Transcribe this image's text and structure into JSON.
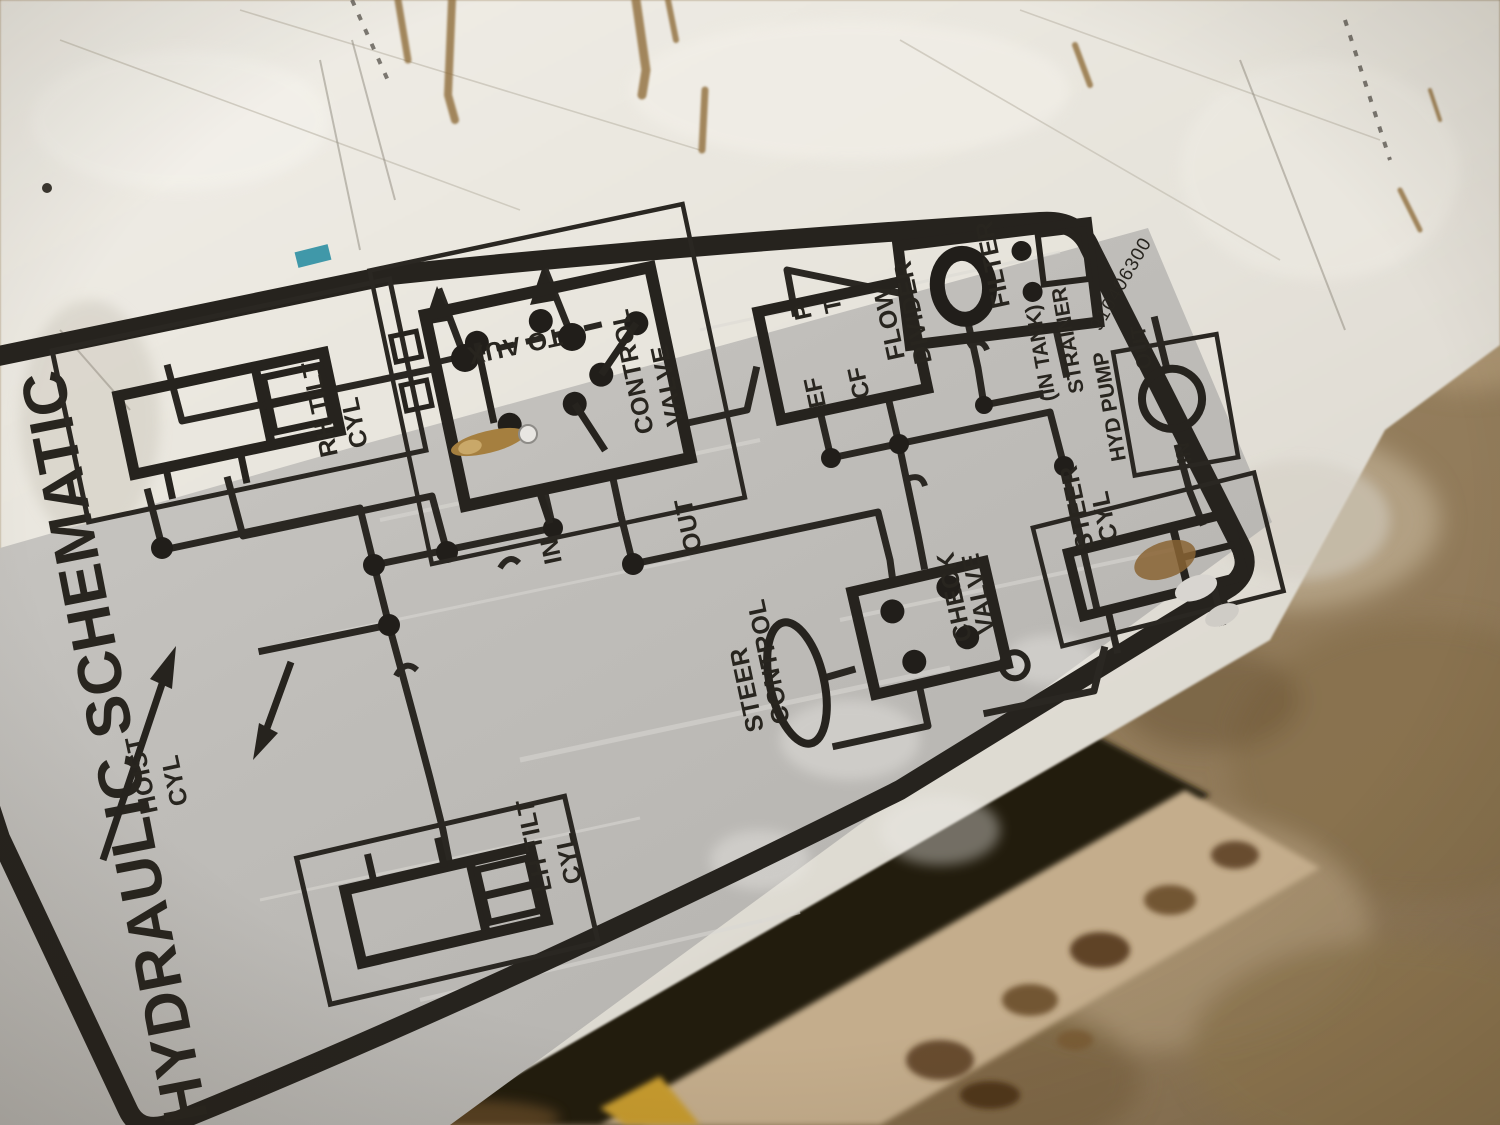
{
  "decal": {
    "title": "HYDRAULIC SCHEMATIC",
    "part_number": "910406300",
    "labels": {
      "rh_tilt_1": "RH TILT",
      "rh_tilt_2": "CYL",
      "lh_tilt_1": "LH TILT",
      "lh_tilt_2": "CYL",
      "hoist_1": "HOIST",
      "hoist_2": "CYL",
      "to_aux": "TO AUX",
      "control_valve_1": "CONTROL",
      "control_valve_2": "VALVE",
      "in_port": "IN",
      "out_port": "OUT",
      "p": "P",
      "t": "T",
      "ef": "EF",
      "cf": "CF",
      "flow_divider_1": "FLOW",
      "flow_divider_2": "DIVIDER",
      "filter": "FILTER",
      "in_tank": "(IN TANK)",
      "strainer": "STRAINER",
      "hyd_pump": "HYD PUMP",
      "pump_out": "OUT",
      "pump_in": "IN",
      "steer_cyl_1": "STEER",
      "steer_cyl_2": "CYL",
      "check_valve_1": "CHECK",
      "check_valve_2": "VALVE",
      "steer_control_1": "STEER",
      "steer_control_2": "CONTROL"
    },
    "colors": {
      "ink": "#2a2722",
      "decal_grey": "#c2c0bc",
      "panel_white": "#eae7e0",
      "floor_brown": "#97815f",
      "rust": "#8a6434",
      "paint_mark_blue": "#2e8fa3"
    }
  }
}
